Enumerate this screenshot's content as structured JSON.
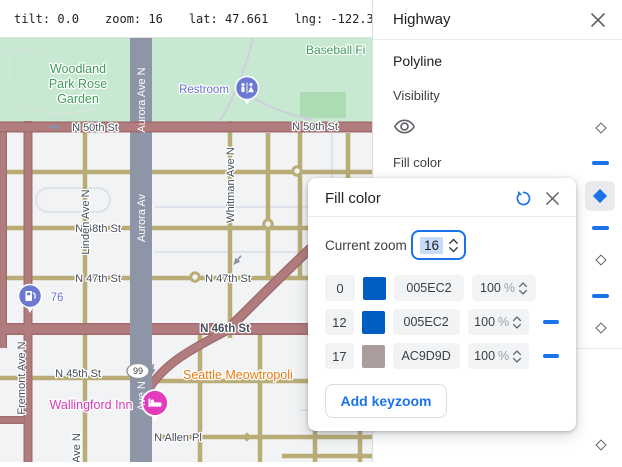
{
  "toolbar": {
    "items": [
      "tilt: 0.0",
      "zoom: 16",
      "lat: 47.661",
      "lng: -122.356"
    ]
  },
  "panel": {
    "title": "Highway",
    "section_label": "Polyline",
    "visibility_label": "Visibility",
    "fill_color_label": "Fill color"
  },
  "dialog": {
    "title": "Fill color",
    "current_zoom_label": "Current zoom",
    "current_zoom_value": "16",
    "add_keyzoom_label": "Add keyzoom",
    "keyzooms": [
      {
        "zoom": "0",
        "color": "#005EC2",
        "hex": "005EC2",
        "opacity": "100",
        "unit": "%"
      },
      {
        "zoom": "12",
        "color": "#005EC2",
        "hex": "005EC2",
        "opacity": "100",
        "unit": "%"
      },
      {
        "zoom": "17",
        "color": "#AC9D9D",
        "hex": "AC9D9D",
        "opacity": "100",
        "unit": "%"
      }
    ]
  },
  "ui_colors": {
    "accent": "#1a73e8",
    "icon_gray": "#5f6368",
    "text_primary": "#202124",
    "text_secondary": "#3c4043",
    "chip_bg": "#f1f3f4",
    "selection_bg": "#c8dcf9",
    "divider": "#e8eaed"
  },
  "map": {
    "colors": {
      "land": "#f1f3f4",
      "park": "#c7e9d1",
      "field": "#abdcb4",
      "park_path": "#ccd2dd",
      "garden_path": "#d9e4dc",
      "road_minor": "#b9ac77",
      "road_light": "#dde3ea",
      "highway_fill": "#b17c7e",
      "highway_casing": "#a16b6d",
      "aurora_road": "#8d95a7",
      "arrow": "#8792a3",
      "street_label": "#454e5a",
      "park_label": "#3f9d5a",
      "poi_blue": "#6471ce",
      "poi_orange": "#ea7b12",
      "poi_pink": "#d43ab5",
      "pin_blue": "#6b79d2",
      "pin_pink": "#e33bbc"
    },
    "labels": {
      "woodland_1": "Woodland",
      "woodland_2": "Park Rose",
      "woodland_3": "Garden",
      "baseball": "Baseball Fi",
      "restroom": "Restroom",
      "gas76": "76",
      "wallingford": "Wallingford Inn",
      "meowtropolis": "Seattle Meowtropoli",
      "shield99": "99",
      "aurora_1": "Aurora Ave N",
      "aurora_2": "Aurora Av",
      "aurora_3": "Ave N",
      "n50_w": "N 50th St",
      "n50_e": "N 50th St",
      "n48": "N 48th St",
      "n47_w": "N 47th St",
      "n47_e": "N 47th St",
      "n46": "N 46th St",
      "n45": "N 45th St",
      "n_allen": "N Allen Pl",
      "linden": "Linden Ave N",
      "whitman": "Whitman Ave N",
      "fremont": "Fremont Ave N",
      "ave_n": "Ave N"
    }
  }
}
